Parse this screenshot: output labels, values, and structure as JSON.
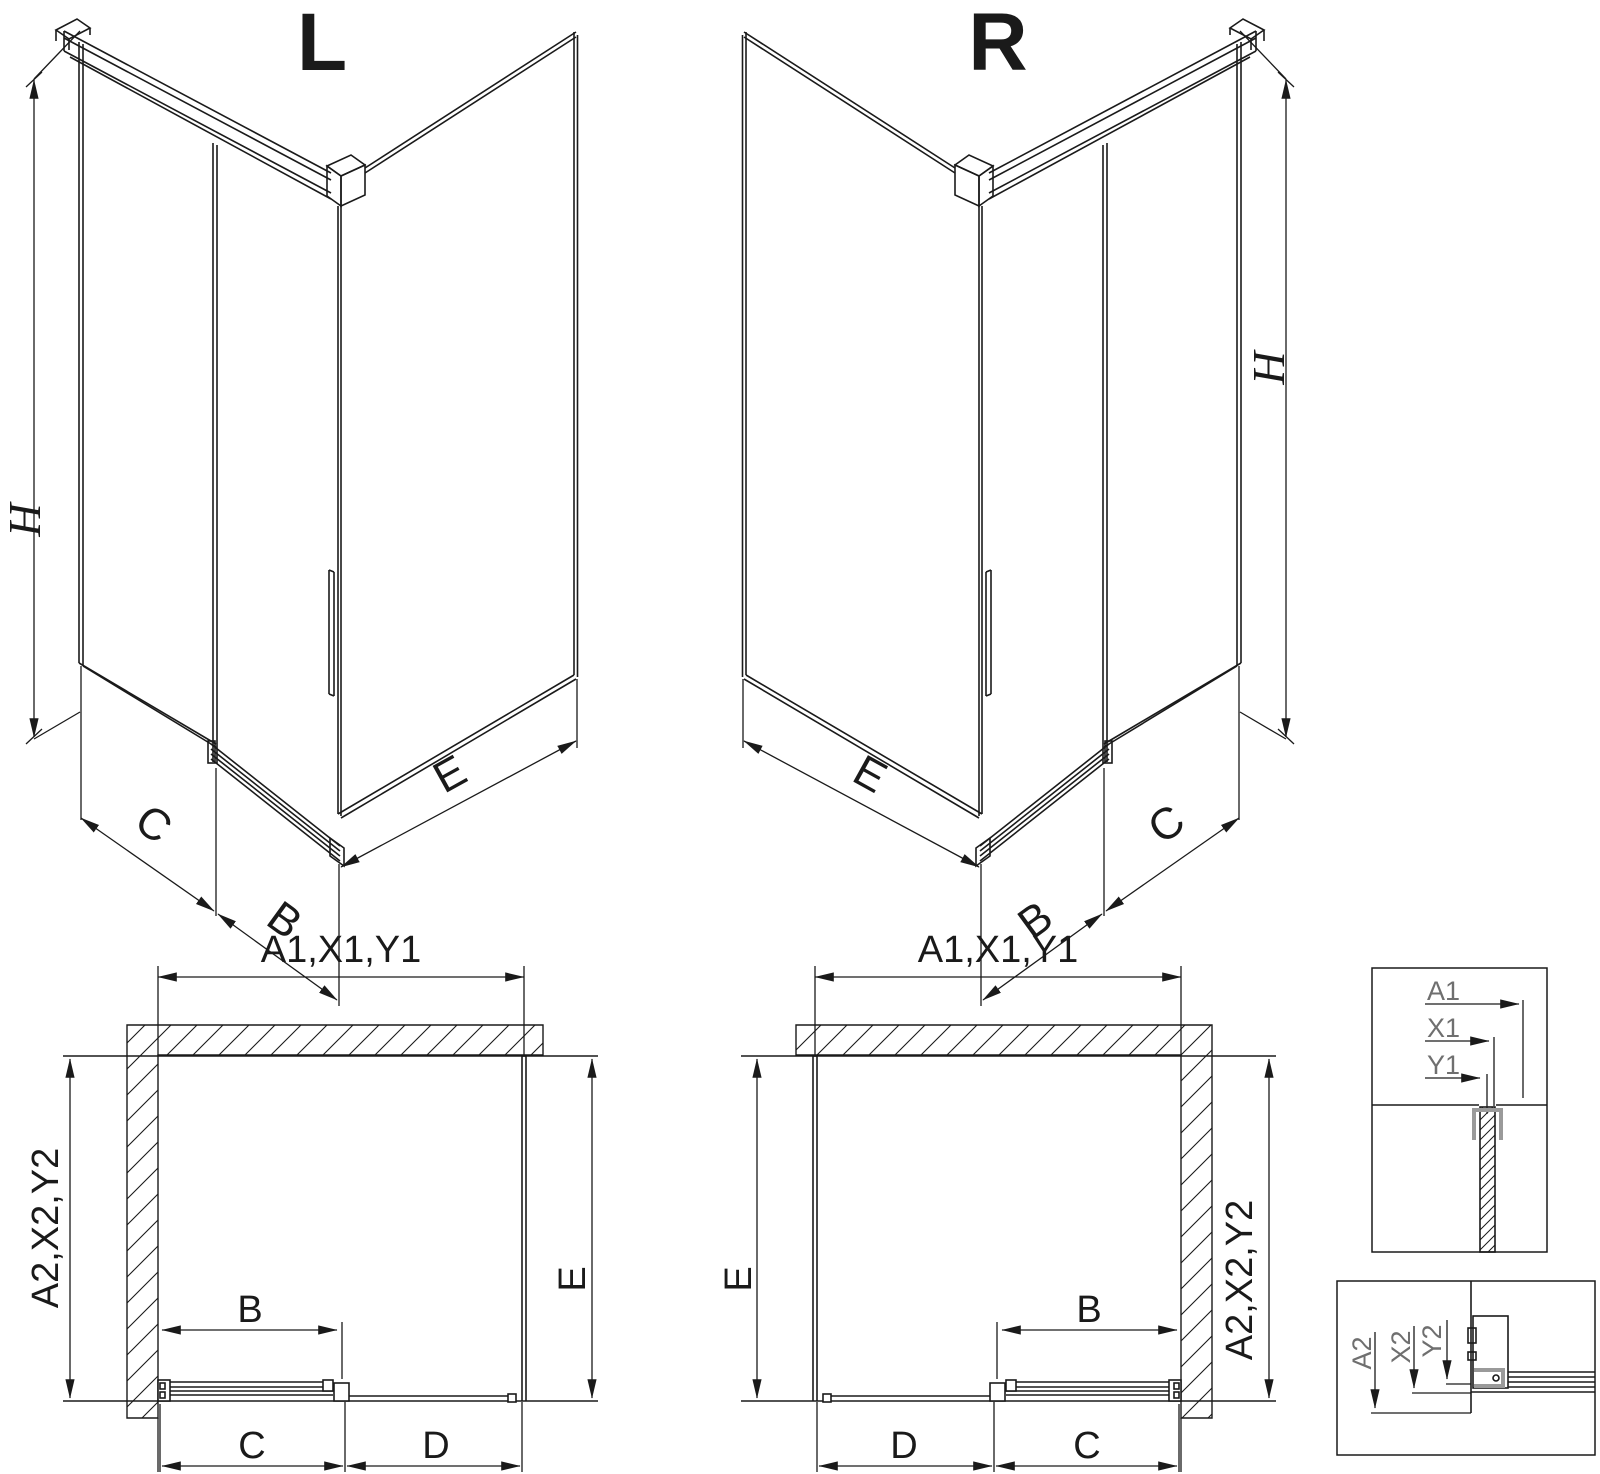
{
  "colors": {
    "line": "#1a1a1a",
    "profile_gray": "#9a9a9a",
    "detail_label_gray": "#6f6f6f",
    "background": "#ffffff"
  },
  "iso_left": {
    "label": "L",
    "dim_height": "H",
    "dim_back": "C",
    "dim_door": "B",
    "dim_side": "E"
  },
  "iso_right": {
    "label": "R",
    "dim_height": "H",
    "dim_back": "C",
    "dim_door": "B",
    "dim_side": "E"
  },
  "plan_left": {
    "dim_top": "A1,X1,Y1",
    "dim_left": "A2,X2,Y2",
    "dim_right": "E",
    "dim_door": "B",
    "dim_bottom_left": "C",
    "dim_bottom_right": "D"
  },
  "plan_right": {
    "dim_top": "A1,X1,Y1",
    "dim_right": "A2,X2,Y2",
    "dim_left": "E",
    "dim_door": "B",
    "dim_bottom_left": "D",
    "dim_bottom_right": "C"
  },
  "detail_top": {
    "dim_a1": "A1",
    "dim_x1": "X1",
    "dim_y1": "Y1"
  },
  "detail_bottom": {
    "dim_a2": "A2",
    "dim_x2": "X2",
    "dim_y2": "Y2"
  }
}
